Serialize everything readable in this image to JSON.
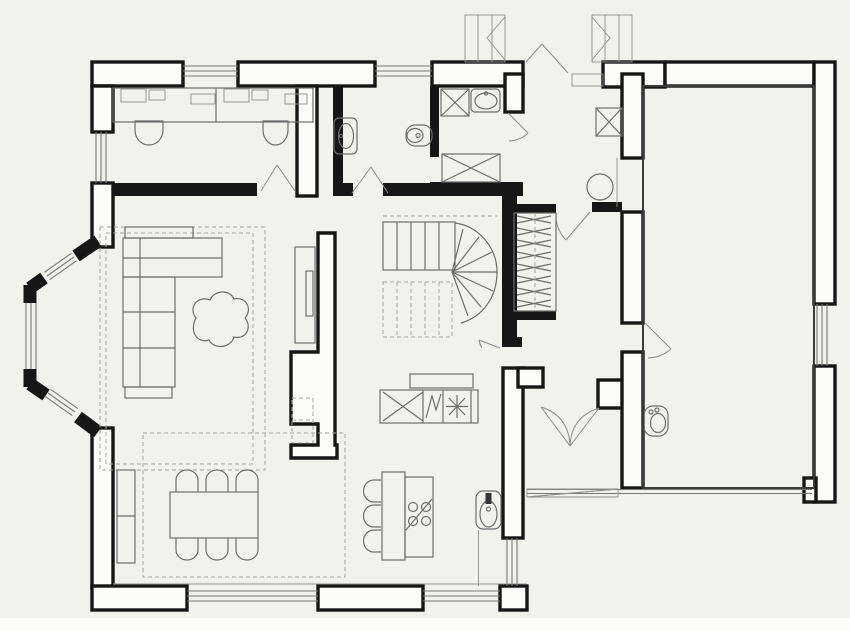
{
  "plan": {
    "kind": "architectural-floor-plan",
    "storey": "ground-floor",
    "palette": {
      "background": "#f1f1ee",
      "wall": "#161616",
      "wall_fill": "#fbfbf9",
      "furniture_line": "#6e6e6e",
      "light_line": "#8f8f8f",
      "dashed_line": "#a3a3a3",
      "door_swing": "#8c8c8c",
      "page_margin": "#fbfbfa"
    },
    "rooms": [
      {
        "id": "office",
        "label": "office-study",
        "fixtures": [
          "double-desk",
          "desk-equipment",
          "task-chair",
          "task-chair",
          "north-window",
          "west-window",
          "double-entry-leaves"
        ]
      },
      {
        "id": "wc-top",
        "label": "wc",
        "fixtures": [
          "wall-washbasin",
          "toilet",
          "swing-door"
        ]
      },
      {
        "id": "bathroom",
        "label": "bathroom",
        "fixtures": [
          "washing-machine",
          "washbasin",
          "shower-cabinet",
          "swing-door"
        ]
      },
      {
        "id": "entry-hall",
        "label": "entry-hall",
        "fixtures": [
          "double-entry-door",
          "exterior-step",
          "porch-step-left",
          "porch-step-right",
          "storage-cabinet-x",
          "round-table",
          "coat-closet",
          "swing-door-to-corridor"
        ]
      },
      {
        "id": "staircase",
        "label": "winder-staircase",
        "fixtures": [
          "upper-flight",
          "winder-fan",
          "lower-flight-dashed",
          "swing-door"
        ]
      },
      {
        "id": "living-room",
        "label": "living-room",
        "fixtures": [
          "corner-sofa",
          "blob-coffee-table",
          "tv-unit",
          "dashed-side-table",
          "area-rug-double-dashed",
          "bay-window-three-lights"
        ]
      },
      {
        "id": "dining-area",
        "label": "dining-area",
        "fixtures": [
          "dining-table",
          "dining-chair",
          "dining-chair",
          "dining-chair",
          "dining-chair",
          "dining-chair",
          "dining-chair",
          "sideboard",
          "area-rug-dashed",
          "terrace-windows"
        ]
      },
      {
        "id": "kitchen",
        "label": "kitchen",
        "fixtures": [
          "counter-run",
          "appliance-x",
          "appliance-zigzag",
          "appliance-asterisk",
          "extractor-hood",
          "island",
          "cooktop-four-burners",
          "bar-stool",
          "bar-stool",
          "bar-stool",
          "sink",
          "east-window"
        ]
      },
      {
        "id": "rear-hall",
        "label": "rear-hall",
        "fixtures": [
          "double-swing-doors",
          "back-exit-steps"
        ]
      },
      {
        "id": "wc-rear",
        "label": "wc",
        "fixtures": [
          "toilet"
        ]
      },
      {
        "id": "garage",
        "label": "garage",
        "fixtures": [
          "garage-door-opening",
          "east-window",
          "swing-door-from-hall"
        ]
      }
    ],
    "symbol_legend": {
      "x-box": "cabinet-or-appliance",
      "zigzag-box": "appliance",
      "asterisk-box": "appliance",
      "triple-parallel-lines": "window",
      "arc-with-line": "door-swing",
      "dashed-rectangles": "rug-or-element-above",
      "hatched-zigzag-strip": "coat-closet-rail",
      "fan-of-lines": "winder-stairs"
    }
  }
}
